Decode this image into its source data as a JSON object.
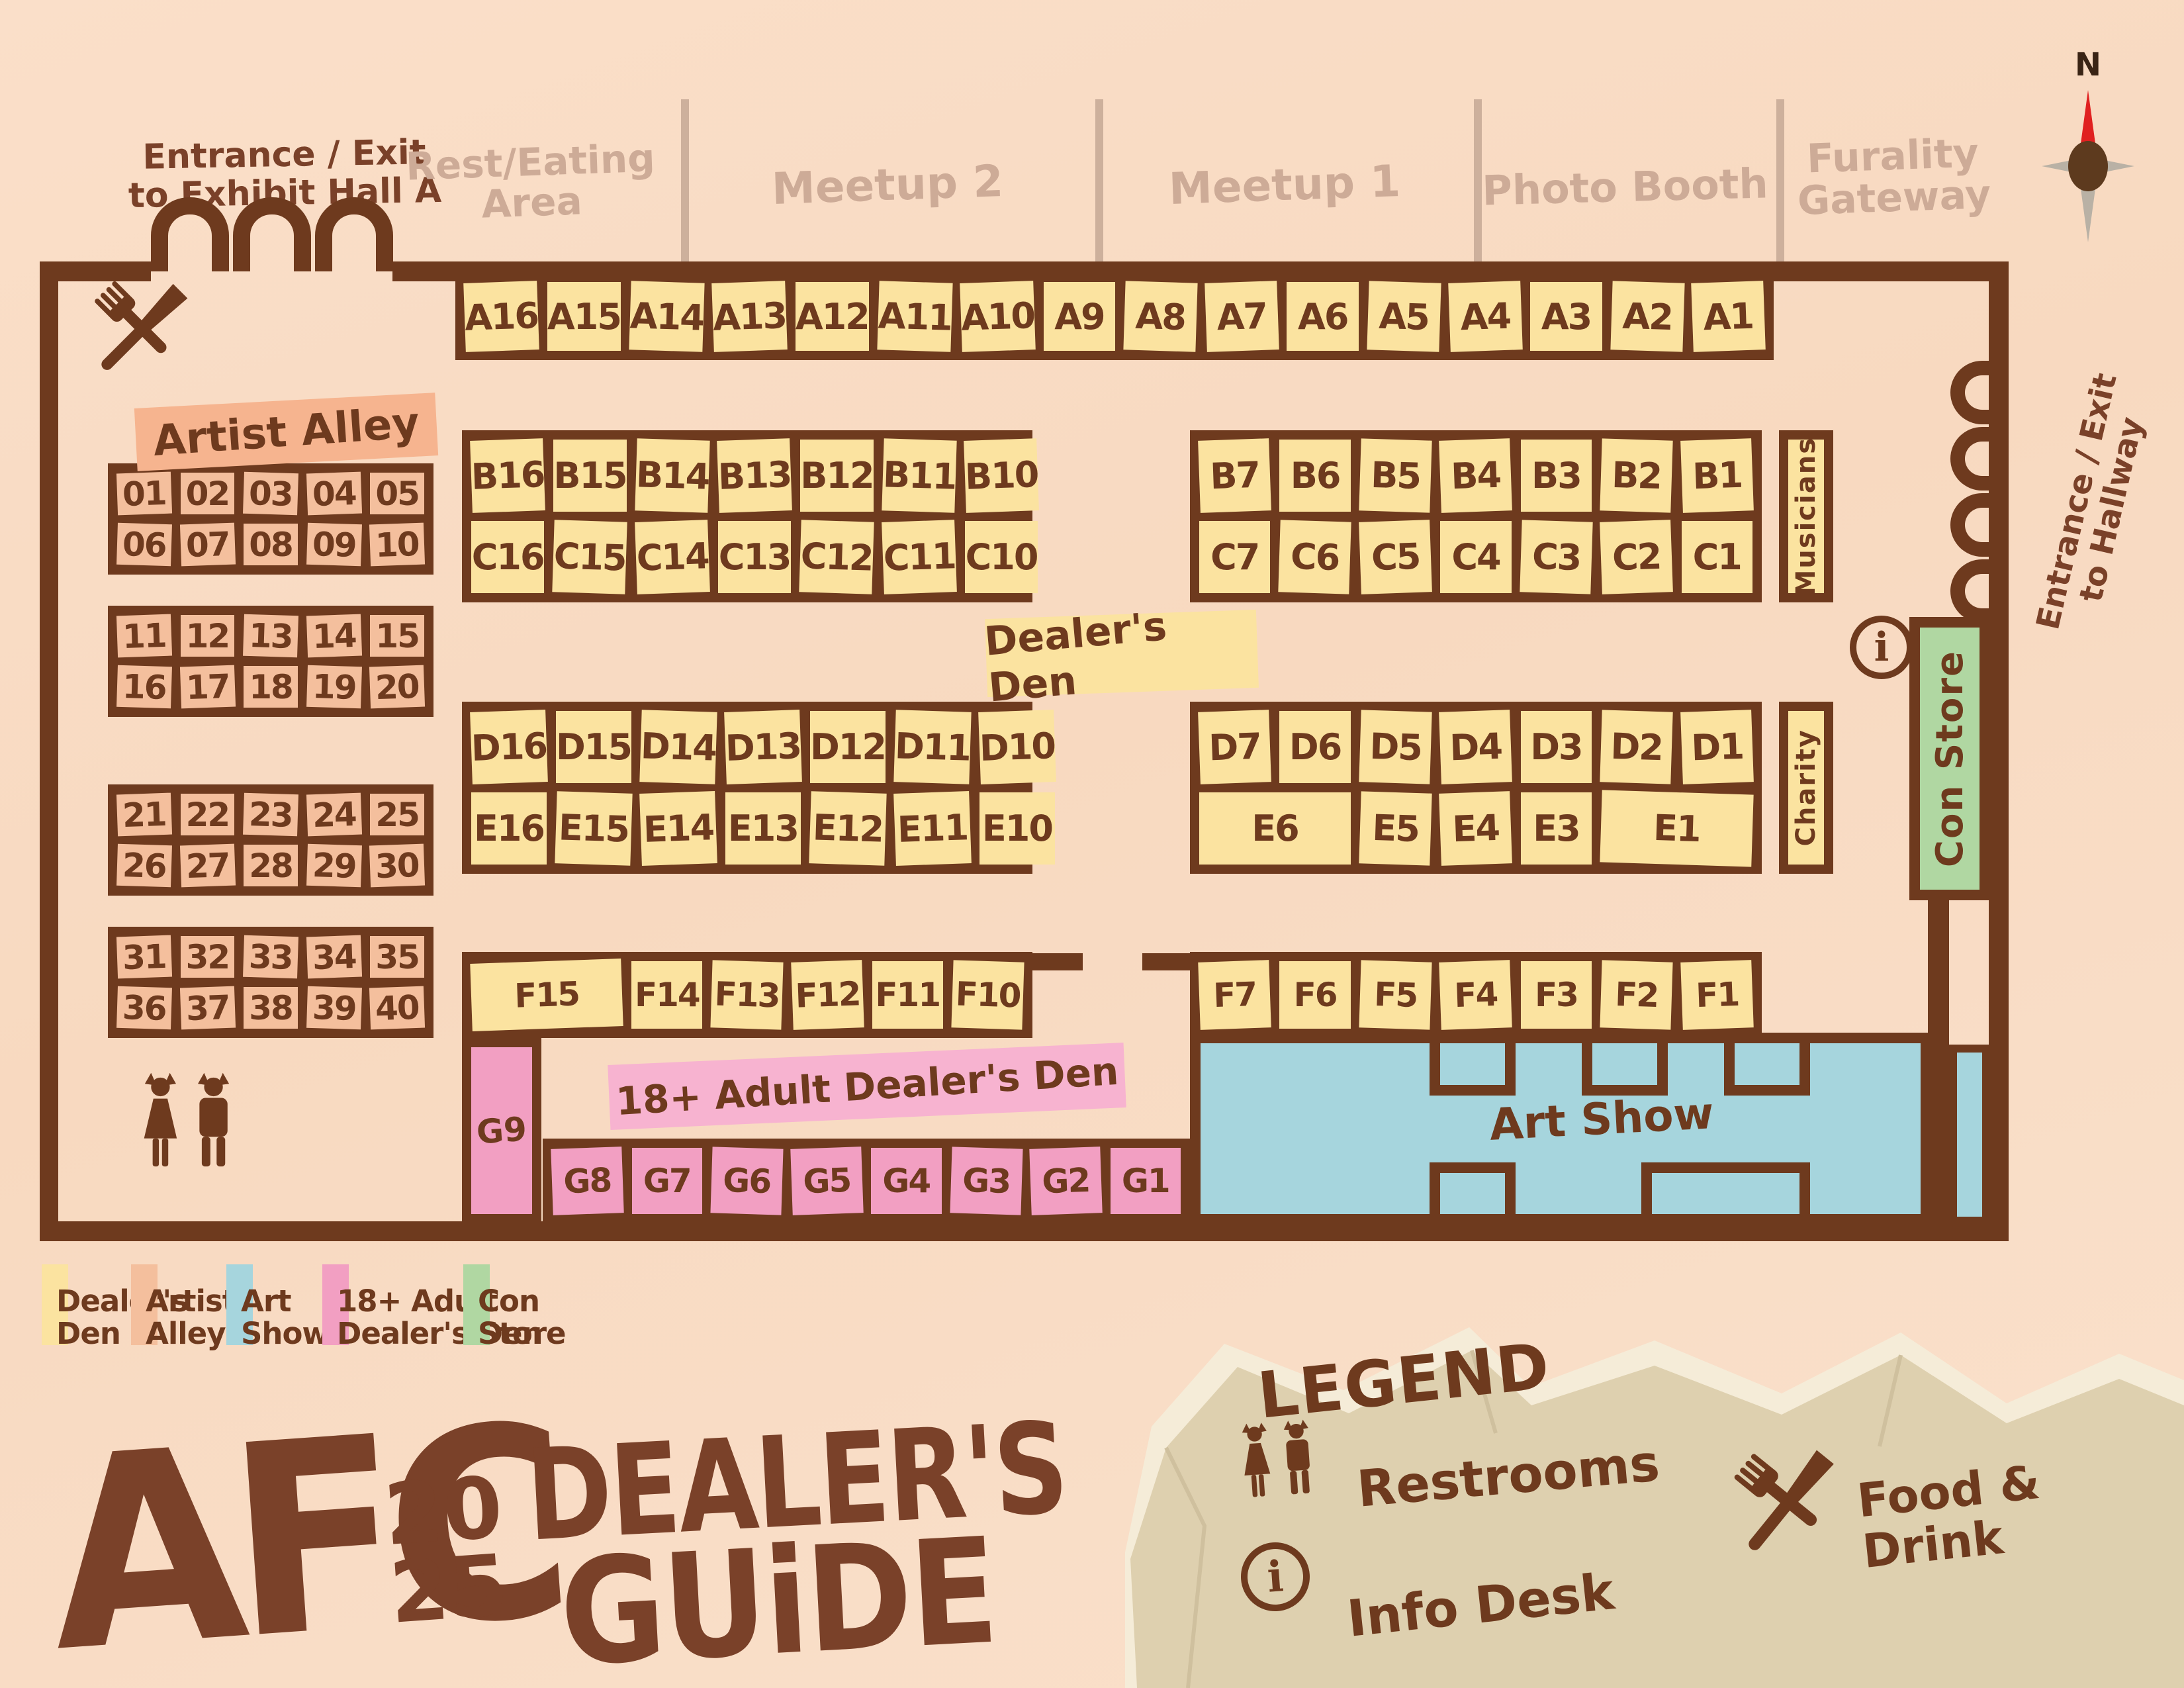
{
  "page_title": "AFC 2025 Dealer's Guide",
  "top_rooms": {
    "entrance_left_1": "Entrance / Exit",
    "entrance_left_2": "to Exhibit Hall A",
    "rest_eating_1": "Rest/Eating",
    "rest_eating_2": "Area",
    "meetup2": "Meetup 2",
    "meetup1": "Meetup 1",
    "photo_booth": "Photo Booth",
    "furality_1": "Furality",
    "furality_2": "Gateway"
  },
  "compass": {
    "north": "N"
  },
  "right_entrance_1": "Entrance / Exit",
  "right_entrance_2": "to Hallway",
  "zones": {
    "artist_alley": "Artist Alley",
    "dealers_den": "Dealer's Den",
    "adult_den": "18+ Adult Dealer's Den",
    "art_show": "Art Show",
    "con_store": "Con Store",
    "musicians": "Musicians",
    "charity": "Charity"
  },
  "booths": {
    "a_row": [
      "A16",
      "A15",
      "A14",
      "A13",
      "A12",
      "A11",
      "A10",
      "A9",
      "A8",
      "A7",
      "A6",
      "A5",
      "A4",
      "A3",
      "A2",
      "A1"
    ],
    "b_left": [
      "B16",
      "B15",
      "B14",
      "B13",
      "B12",
      "B11",
      "B10"
    ],
    "c_left": [
      "C16",
      "C15",
      "C14",
      "C13",
      "C12",
      "C11",
      "C10"
    ],
    "b_right": [
      "B7",
      "B6",
      "B5",
      "B4",
      "B3",
      "B2",
      "B1"
    ],
    "c_right": [
      "C7",
      "C6",
      "C5",
      "C4",
      "C3",
      "C2",
      "C1"
    ],
    "d_left": [
      "D16",
      "D15",
      "D14",
      "D13",
      "D12",
      "D11",
      "D10"
    ],
    "e_left": [
      "E16",
      "E15",
      "E14",
      "E13",
      "E12",
      "E11",
      "E10"
    ],
    "d_right": [
      "D7",
      "D6",
      "D5",
      "D4",
      "D3",
      "D2",
      "D1"
    ],
    "e_right": [
      {
        "t": "E6",
        "w": 2
      },
      {
        "t": "E5",
        "w": 1
      },
      {
        "t": "E4",
        "w": 1
      },
      {
        "t": "E3",
        "w": 1
      },
      {
        "t": "E1",
        "w": 2
      }
    ],
    "f_left": [
      {
        "t": "F15",
        "w": 2
      },
      {
        "t": "F14",
        "w": 1
      },
      {
        "t": "F13",
        "w": 1
      },
      {
        "t": "F12",
        "w": 1
      },
      {
        "t": "F11",
        "w": 1
      },
      {
        "t": "F10",
        "w": 1
      }
    ],
    "f_right": [
      "F7",
      "F6",
      "F5",
      "F4",
      "F3",
      "F2",
      "F1"
    ],
    "g_tall": "G9",
    "g_row": [
      "G8",
      "G7",
      "G6",
      "G5",
      "G4",
      "G3",
      "G2",
      "G1"
    ],
    "artist_blocks": [
      [
        "01",
        "02",
        "03",
        "04",
        "05",
        "06",
        "07",
        "08",
        "09",
        "10"
      ],
      [
        "11",
        "12",
        "13",
        "14",
        "15",
        "16",
        "17",
        "18",
        "19",
        "20"
      ],
      [
        "21",
        "22",
        "23",
        "24",
        "25",
        "26",
        "27",
        "28",
        "29",
        "30"
      ],
      [
        "31",
        "32",
        "33",
        "34",
        "35",
        "36",
        "37",
        "38",
        "39",
        "40"
      ]
    ]
  },
  "legend_swatches": [
    {
      "line1": "Dealer's",
      "line2": "Den",
      "color": "#fbe3a0"
    },
    {
      "line1": "Artist",
      "line2": "Alley",
      "color": "#f4bf9d"
    },
    {
      "line1": "Art",
      "line2": "Show",
      "color": "#a6d5dd"
    },
    {
      "line1": "18+ Adult",
      "line2": "Dealer's Den",
      "color": "#f29fc2"
    },
    {
      "line1": "Con",
      "line2": "Store",
      "color": "#b0d7a2"
    }
  ],
  "legend_box": {
    "title": "LEGEND",
    "restrooms": "Restrooms",
    "info_desk": "Info Desk",
    "food_1": "Food &",
    "food_2": "Drink"
  },
  "logo": {
    "afc": "AFC",
    "year_top": "20",
    "year_bottom": "25",
    "guide1": "DEALER'S",
    "guide2": "GUiDE"
  }
}
